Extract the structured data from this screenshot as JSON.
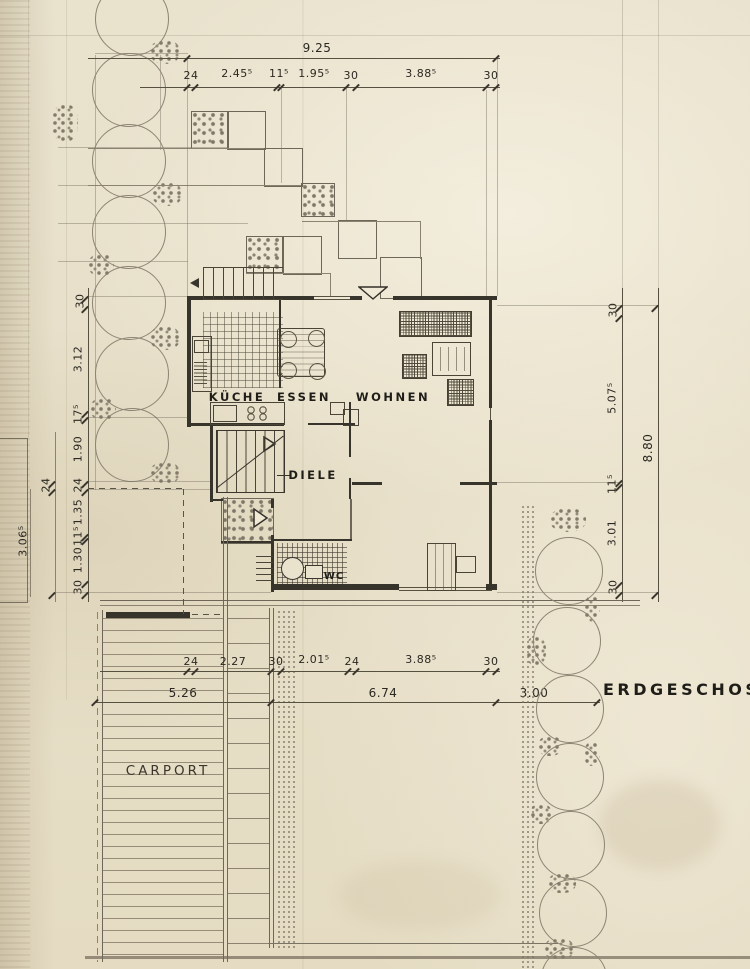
{
  "title": "ERDGESCHOSS",
  "rooms": {
    "kueche": "KÜCHE",
    "essen": "ESSEN",
    "wohnen": "WOHNEN",
    "diele": "DIELE",
    "wc": "WC",
    "carport": "CARPORT"
  },
  "dimensions": {
    "top_total": "9.25",
    "top_chain": [
      "24",
      "2.45⁵",
      "11⁵",
      "1.95⁵",
      "30",
      "3.88⁵",
      "30"
    ],
    "left_chain": [
      "30",
      "3.12",
      "17⁵",
      "1.90",
      "24",
      "1.35",
      "11⁵",
      "1.30",
      "30"
    ],
    "left_outer": [
      "24",
      "3.06⁵"
    ],
    "right_chain": [
      "30",
      "5.07⁵",
      "11⁵",
      "3.01",
      "30"
    ],
    "right_total": "8.80",
    "bottom_chain": [
      "24",
      "2.27",
      "30",
      "2.01⁵",
      "24",
      "3.88⁵",
      "30"
    ],
    "bottom_totals": [
      "5.26",
      "6.74",
      "3.00"
    ]
  },
  "colors": {
    "paper": "#e8e1cb",
    "ink": "#37342c",
    "pencil": "#7b7363"
  }
}
